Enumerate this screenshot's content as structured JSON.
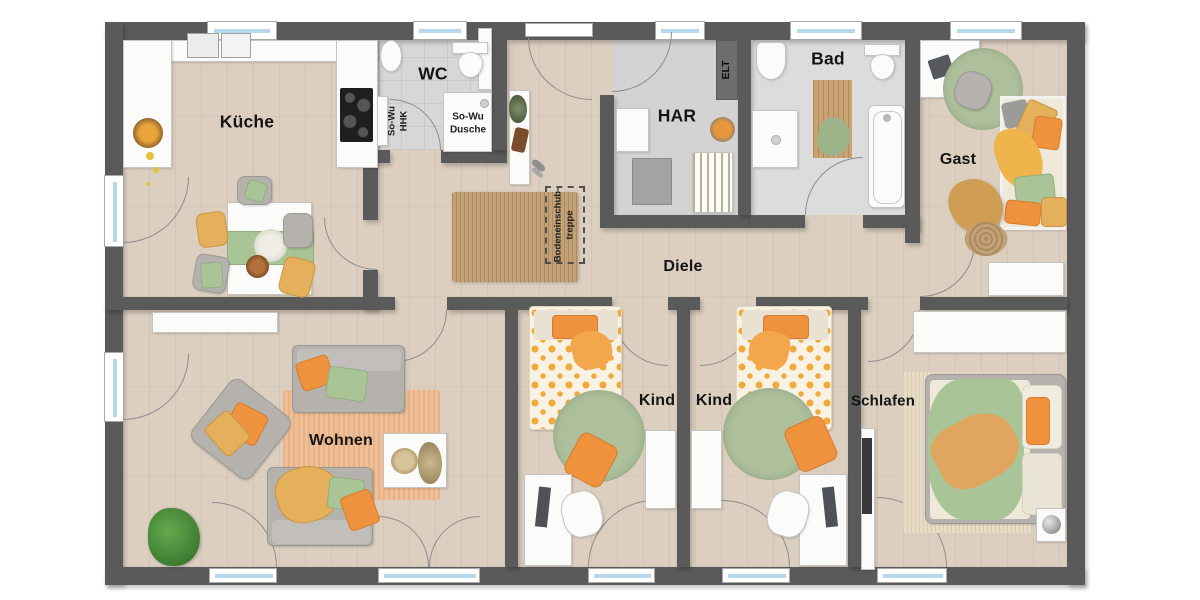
{
  "plan_type": "floor-plan",
  "rooms": {
    "kueche": {
      "label": "Küche"
    },
    "wc": {
      "label": "WC"
    },
    "har": {
      "label": "HAR"
    },
    "bad": {
      "label": "Bad"
    },
    "gast": {
      "label": "Gast"
    },
    "diele": {
      "label": "Diele"
    },
    "wohnen": {
      "label": "Wohnen"
    },
    "kind1": {
      "label": "Kind"
    },
    "kind2": {
      "label": "Kind"
    },
    "schlafen": {
      "label": "Schlafen"
    }
  },
  "annotations": {
    "shower": {
      "line1": "So-Wu",
      "line2": "Dusche"
    },
    "radiator": {
      "line1": "So-Wu",
      "line2": "HHK"
    },
    "electrical": {
      "label": "ELT"
    },
    "attic_stairs": {
      "line1": "Bodeneinschub-",
      "line2": "treppe"
    }
  },
  "colors": {
    "wall": "#5a5a5a",
    "floor_wood": "#dccfc0",
    "floor_tile": "#d7d7d7",
    "window_glass": "#b7d7ec",
    "accent_orange": "#ee923d",
    "accent_sage": "#a9c497",
    "accent_mustard": "#e4b05c",
    "rug_green": "#9cb189",
    "rug_jute": "#c3a176",
    "rug_peach": "#eec09a"
  }
}
